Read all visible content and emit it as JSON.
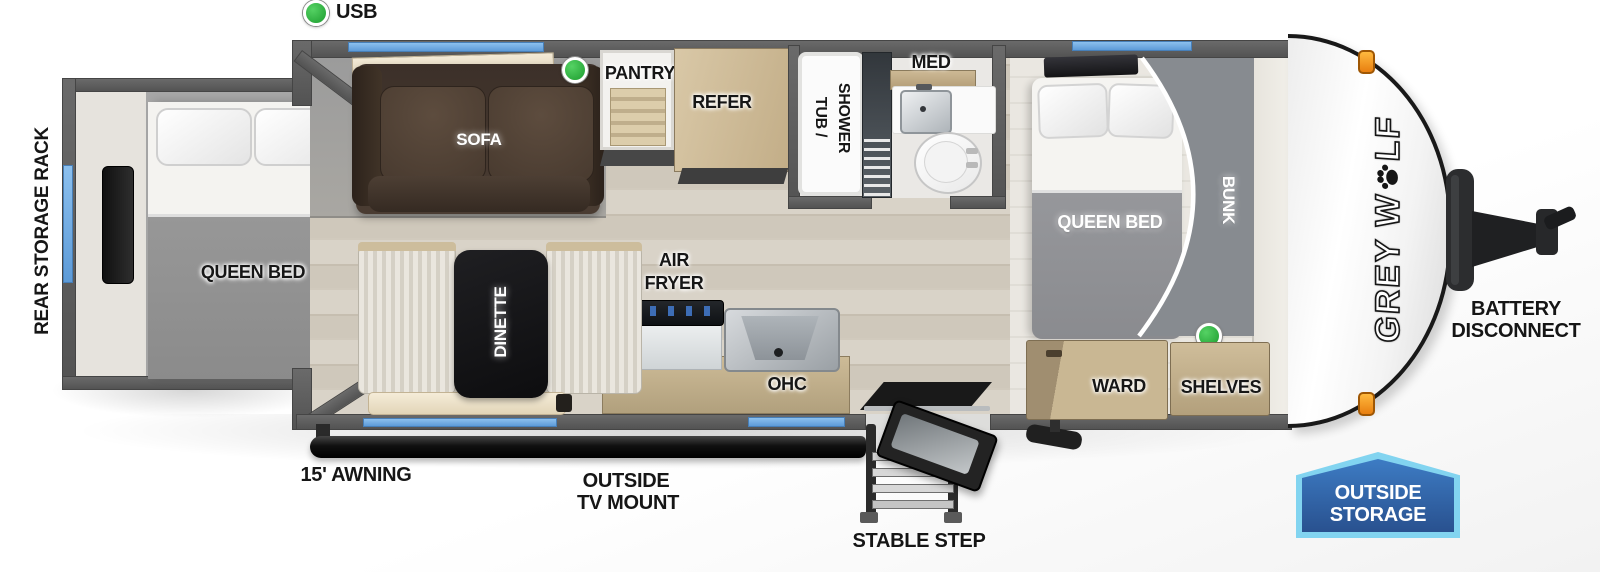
{
  "colors": {
    "window_blue": "#68a7e3",
    "indicator_green": "#2fae44",
    "badge_blue_fill": "#2e62a8",
    "badge_blue_border": "#7fd2ef",
    "wood_cabinet": "#c7b592",
    "sofa_brown": "#4a3c32",
    "wall_gray": "#5c5c5c"
  },
  "indicators": {
    "usb_label": "USB"
  },
  "rear": {
    "rack_label": "REAR STORAGE RACK",
    "bed_label": "QUEEN BED"
  },
  "living": {
    "sofa_label": "SOFA",
    "dinette_label": "DINETTE",
    "pantry_label": "PANTRY",
    "refer_label": "REFER"
  },
  "kitchen": {
    "air_fryer_line1": "AIR",
    "air_fryer_line2": "FRYER",
    "ohc_label": "OHC"
  },
  "bath": {
    "tub_line1": "TUB /",
    "tub_line2": "SHOWER",
    "med_label": "MED"
  },
  "bedroom": {
    "bed_label": "QUEEN BED",
    "bunk_label": "BUNK",
    "ward_label": "WARD",
    "shelves_label": "SHELVES"
  },
  "exterior": {
    "awning_label": "15' AWNING",
    "tv_mount_line1": "OUTSIDE",
    "tv_mount_line2": "TV MOUNT",
    "step_label": "STABLE STEP",
    "battery_line1": "BATTERY",
    "battery_line2": "DISCONNECT",
    "storage_line1": "OUTSIDE",
    "storage_line2": "STORAGE"
  },
  "branding": {
    "name_part1": "GREY W",
    "name_part2": "LF"
  }
}
